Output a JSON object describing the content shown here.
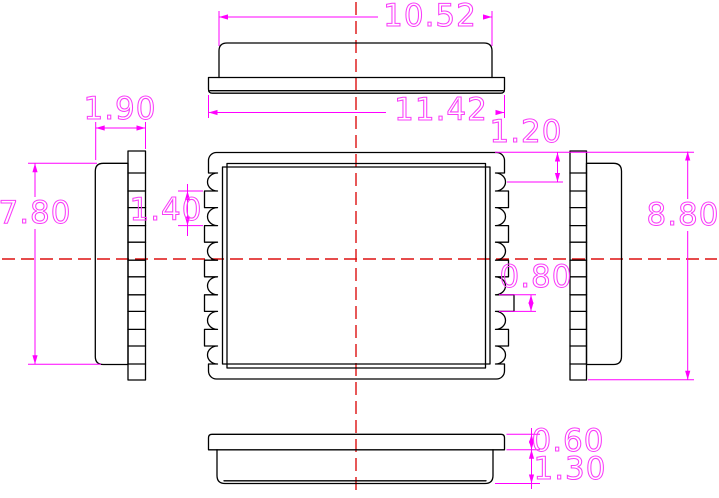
{
  "dimensions": {
    "top_view": {
      "lid_width": "10.52",
      "base_width": "11.42"
    },
    "left_view": {
      "thickness": "1.90",
      "lid_height": "7.80"
    },
    "main_view": {
      "pad_pitch": "1.40",
      "edge_to_first_pad": "1.20",
      "pad_length": "0.80"
    },
    "right_view": {
      "overall_height": "8.80"
    },
    "bottom_view": {
      "base_thickness": "0.60",
      "lid_thickness": "1.30"
    }
  },
  "colors": {
    "outline": "#000000",
    "dimension_line": "#ff00ff",
    "dimension_text": "#f93df9",
    "centerline": "#dd1111",
    "background": "#ffffff"
  }
}
